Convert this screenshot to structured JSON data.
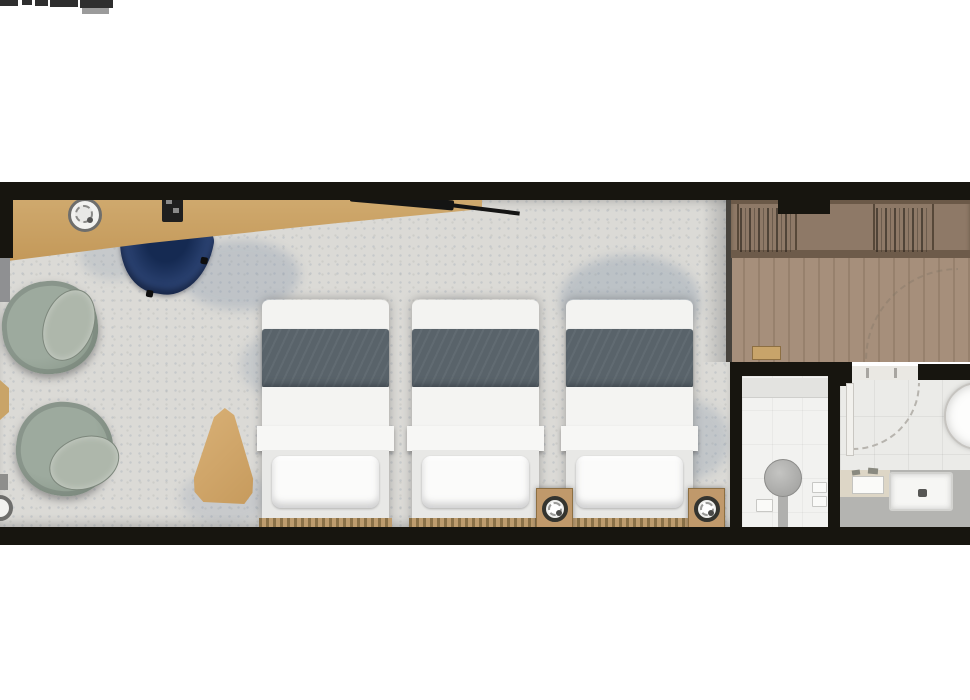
{
  "canvas": {
    "width": 970,
    "height": 700,
    "background": "#ffffff"
  },
  "cropped_text_fragment": {
    "note": "partially cropped dark glyphs at very top-left corner of image"
  },
  "floorplan": {
    "wall_color": "#17150f",
    "rooms": {
      "bedroom": {
        "name": "Bedroom / living area",
        "floor": "speckled terrazzo carpet",
        "floor_color": "#dbdad6"
      },
      "entry": {
        "name": "Entry / dressing area",
        "floor": "wood planks",
        "floor_color": "#a18a76"
      },
      "wc": {
        "name": "Shower room",
        "floor_color": "#f2f2f0"
      },
      "bathroom": {
        "name": "Bathroom",
        "floor_color": "#ebebe8"
      }
    },
    "furniture": {
      "desk": {
        "name": "Desk / console along top wall",
        "color": "#c9a267"
      },
      "desk_tray": {
        "name": "Round tray with cup"
      },
      "desk_device": {
        "name": "Desk accessory"
      },
      "tv": {
        "name": "Wall-mounted TV"
      },
      "desk_chair": {
        "name": "Curved desk chair",
        "color": "#2d4570"
      },
      "armchair_1": {
        "name": "Swivel armchair",
        "color": "#96a296"
      },
      "armchair_2": {
        "name": "Swivel armchair",
        "color": "#96a296"
      },
      "side_table": {
        "name": "Pebble-shaped side table",
        "color": "#d0a76d"
      },
      "bed_count": 3,
      "bed_1": {
        "name": "Single bed"
      },
      "bed_2": {
        "name": "Single bed"
      },
      "bed_3": {
        "name": "Single bed"
      },
      "blanket_color": "#59636a",
      "nightstand_1": {
        "name": "Nightstand with lamp"
      },
      "nightstand_2": {
        "name": "Nightstand with lamp"
      },
      "nightstand_edge": {
        "name": "Nightstand lamp cut off at left edge"
      },
      "wardrobe": {
        "name": "Open wardrobe with hanging clothes",
        "color": "#8c7765"
      },
      "bench": {
        "name": "Entry stool"
      },
      "shower_fixture": {
        "name": "Shower / WC fixture"
      },
      "door_bath": {
        "name": "Bathroom door with swing arc"
      },
      "door_entry": {
        "name": "Entry door swing arc"
      },
      "basin": {
        "name": "Round basin"
      },
      "vanity": {
        "name": "Vanity counter with sink",
        "color": "#b2b2af"
      }
    }
  }
}
